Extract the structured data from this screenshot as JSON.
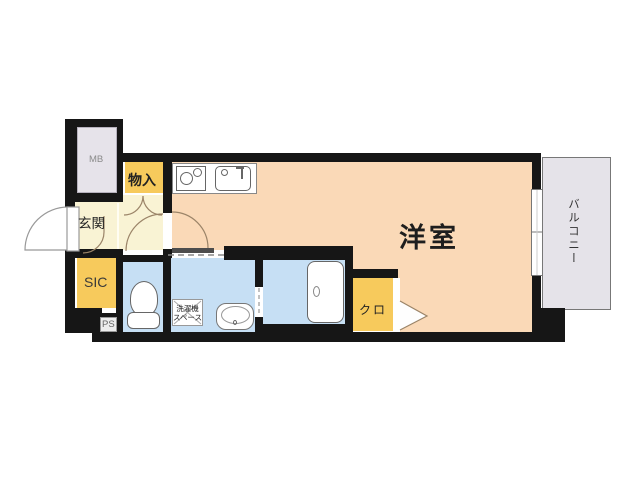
{
  "plan_title": "apartment-floor-plan",
  "rooms": {
    "western_room": {
      "label": "洋室"
    },
    "balcony": {
      "label": "バルコニー"
    },
    "entrance": {
      "label": "玄関"
    },
    "shoe_closet": {
      "label": "SIC"
    },
    "storage": {
      "label": "物入"
    },
    "closet": {
      "label": "クロ"
    },
    "meter_box": {
      "label": "MB"
    },
    "pipe_space": {
      "label": "PS"
    },
    "washer_space": {
      "line1": "洗濯機",
      "line2": "スペース"
    }
  },
  "colors": {
    "wall": "#161616",
    "room_peach": "#fad9b7",
    "entrance_cream": "#f9f3d4",
    "storage_yellow": "#f7ca5c",
    "wet_area_blue": "#c6dff4",
    "service_gray": "#e6e3ea",
    "balcony_gray": "#e5e3e9",
    "door_arc": "#9b8468"
  }
}
